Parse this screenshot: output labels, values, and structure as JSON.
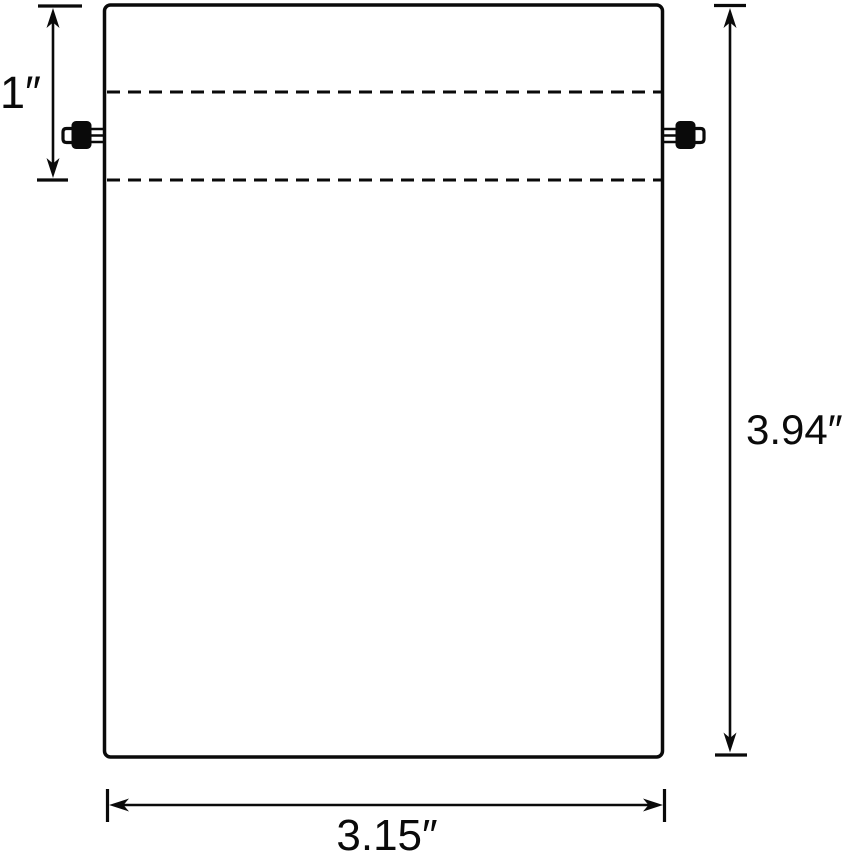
{
  "canvas": {
    "width": 844,
    "height": 856,
    "background_color": "#ffffff",
    "line_color": "#0a0a0a"
  },
  "diagram": {
    "type": "dimension-drawing",
    "subject": "drawstring-pouch-front-view",
    "features": {
      "hem_fold_lines": "dashed",
      "cord_locks": [
        "left",
        "right"
      ]
    },
    "dimensions": {
      "hem_height": {
        "label": "1″",
        "value_inches": 1
      },
      "bag_height": {
        "label": "3.94″",
        "value_inches": 3.94
      },
      "bag_width": {
        "label": "3.15″",
        "value_inches": 3.15
      }
    }
  }
}
